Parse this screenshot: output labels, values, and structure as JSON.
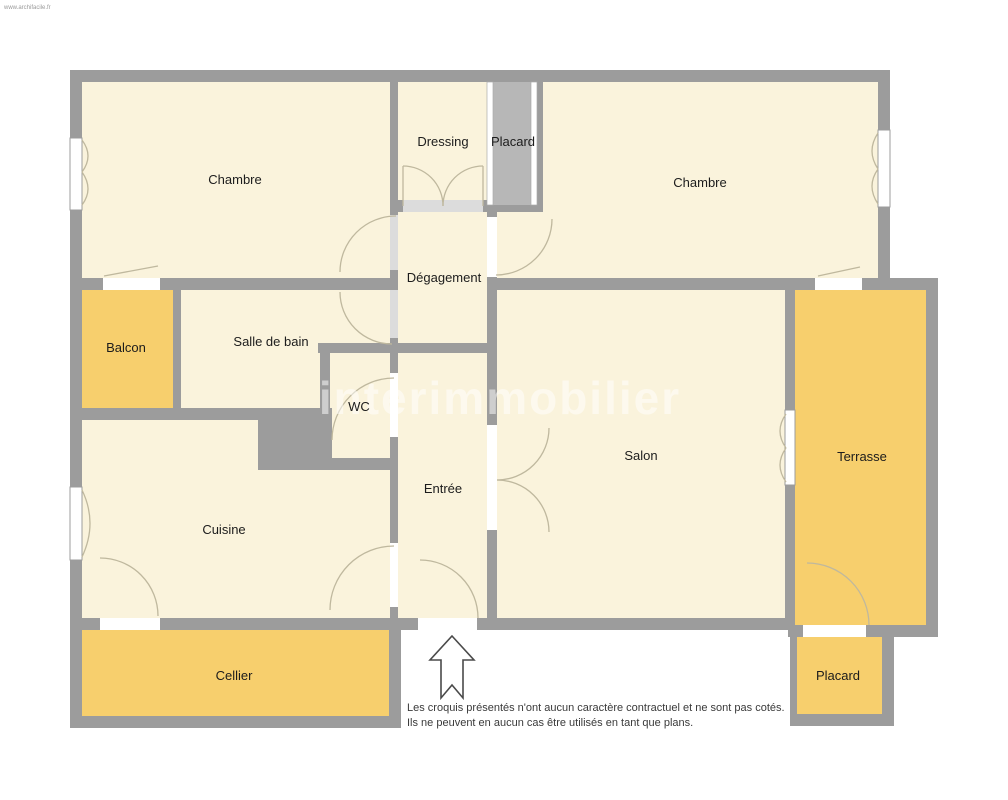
{
  "watermarks": {
    "top_left": "www.archifacile.fr",
    "center": "interimmobilier"
  },
  "rooms": [
    {
      "key": "chambre-1",
      "label": "Chambre",
      "type": "interior"
    },
    {
      "key": "dressing",
      "label": "Dressing",
      "type": "interior"
    },
    {
      "key": "placard-haut",
      "label": "Placard",
      "type": "storage"
    },
    {
      "key": "chambre-2",
      "label": "Chambre",
      "type": "interior"
    },
    {
      "key": "degagement",
      "label": "Dégagement",
      "type": "interior"
    },
    {
      "key": "balcon",
      "label": "Balcon",
      "type": "exterior"
    },
    {
      "key": "salle-de-bain",
      "label": "Salle de bain",
      "type": "interior"
    },
    {
      "key": "wc",
      "label": "WC",
      "type": "interior"
    },
    {
      "key": "salon",
      "label": "Salon",
      "type": "interior"
    },
    {
      "key": "entree",
      "label": "Entrée",
      "type": "interior"
    },
    {
      "key": "cuisine",
      "label": "Cuisine",
      "type": "interior"
    },
    {
      "key": "terrasse",
      "label": "Terrasse",
      "type": "exterior"
    },
    {
      "key": "cellier",
      "label": "Cellier",
      "type": "exterior"
    },
    {
      "key": "placard-bas",
      "label": "Placard",
      "type": "storage"
    }
  ],
  "disclaimer": {
    "line1": "Les croquis présentés n'ont aucun caractère contractuel et ne sont pas cotés.",
    "line2": "Ils ne peuvent en aucun cas être utilisés en tant que plans."
  },
  "colors": {
    "interior_fill": "#FAF3DC",
    "exterior_fill": "#F7CF6D",
    "wall": "#9C9C9C",
    "closet_fill": "#B7B7B7",
    "door_arc": "#BFB89E",
    "background": "#FFFFFF"
  }
}
